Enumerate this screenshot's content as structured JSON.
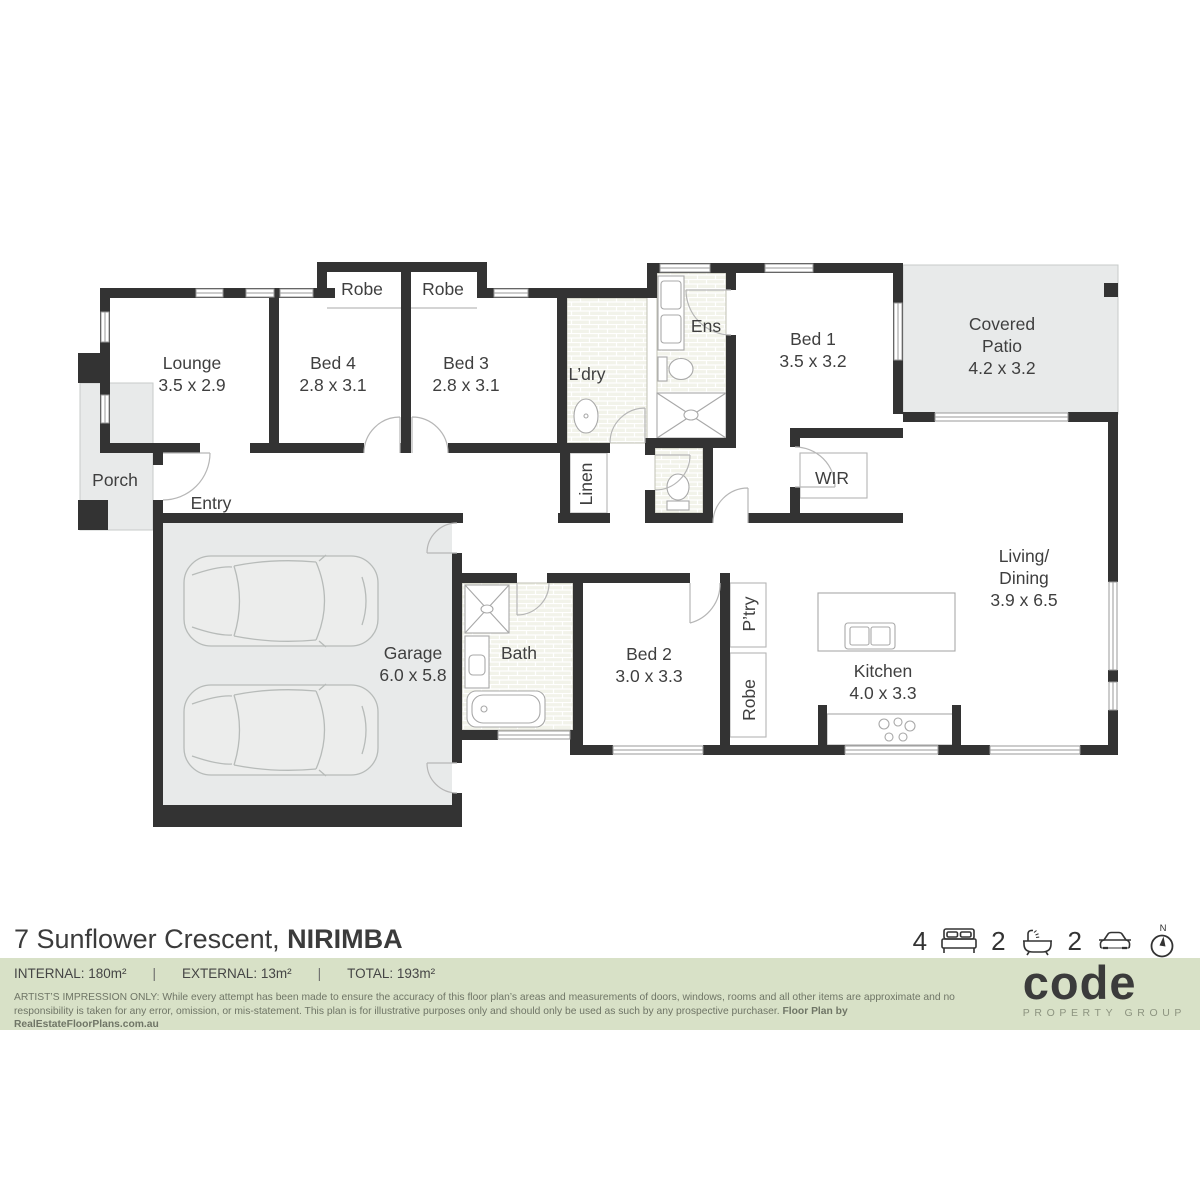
{
  "rooms": {
    "lounge": {
      "name": "Lounge",
      "dims": "3.5 x 2.9"
    },
    "bed4": {
      "name": "Bed 4",
      "dims": "2.8 x 3.1"
    },
    "bed3": {
      "name": "Bed 3",
      "dims": "2.8 x 3.1"
    },
    "robe_bed4": {
      "name": "Robe"
    },
    "robe_bed3": {
      "name": "Robe"
    },
    "ldry": {
      "name": "L’dry"
    },
    "ens": {
      "name": "Ens"
    },
    "bed1": {
      "name": "Bed 1",
      "dims": "3.5 x 3.2"
    },
    "patio": {
      "name": "Covered",
      "name2": "Patio",
      "dims": "4.2 x 3.2"
    },
    "porch": {
      "name": "Porch"
    },
    "entry": {
      "name": "Entry"
    },
    "linen": {
      "name": "Linen"
    },
    "wir": {
      "name": "WIR"
    },
    "garage": {
      "name": "Garage",
      "dims": "6.0 x 5.8"
    },
    "bath": {
      "name": "Bath"
    },
    "bed2": {
      "name": "Bed 2",
      "dims": "3.0 x 3.3"
    },
    "ptry": {
      "name": "P’try"
    },
    "robe_bed2": {
      "name": "Robe"
    },
    "kitchen": {
      "name": "Kitchen",
      "dims": "4.0 x 3.3"
    },
    "living": {
      "name": "Living/",
      "name2": "Dining",
      "dims": "3.9 x 6.5"
    }
  },
  "footer": {
    "address_regular": "7 Sunflower Crescent, ",
    "address_bold": "NIRIMBA",
    "summary": {
      "beds": "4",
      "baths": "2",
      "cars": "2",
      "compass_label": "N",
      "icons": [
        "bed-icon",
        "bath-icon",
        "car-icon",
        "compass-icon"
      ]
    },
    "areas": {
      "items": [
        {
          "label": "INTERNAL: 180m²"
        },
        {
          "label": "EXTERNAL: 13m²"
        },
        {
          "label": "TOTAL: 193m²"
        }
      ],
      "separator": "|"
    },
    "disclaimer_line1": "ARTIST’S IMPRESSION ONLY: While every attempt has been made to ensure the accuracy of this floor plan’s areas and measurements of doors, windows, rooms and all other items are approximate and no responsibility is taken",
    "disclaimer_line2": "for any error, omission, or mis-statement. This plan is for illustrative purposes only and should only be used as such by any prospective purchaser. ",
    "disclaimer_bold": "Floor Plan by RealEstateFloorPlans.com.au",
    "logo": {
      "text": "code",
      "subtext": "PROPERTY GROUP"
    }
  },
  "colors": {
    "wall": "#333333",
    "accent_bar": "#d8e1c7",
    "tile_fill": "#f2f3ea",
    "gray_fill": "#e8eaea",
    "logo_text": "#3b3b3b",
    "logo_sub": "#8d9480"
  }
}
